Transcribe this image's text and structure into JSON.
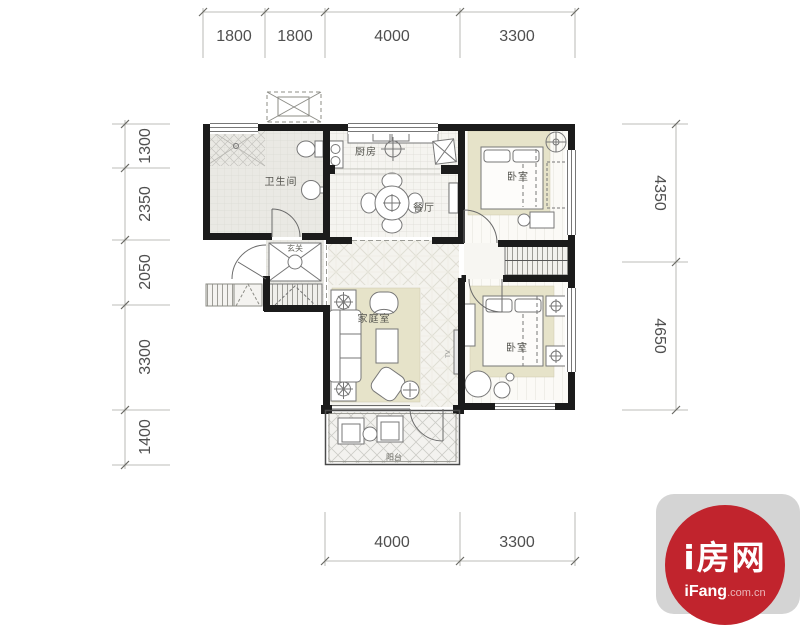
{
  "branding": {
    "site_name": "i房网",
    "domain_bold": "iFang",
    "domain_rest": ".com.cn",
    "brand_red": "#c1242d",
    "tile_gray": "#d4d4d4"
  },
  "floorplan": {
    "rooms": [
      {
        "id": "bathroom",
        "label": "卫生间"
      },
      {
        "id": "kitchen",
        "label": "厨房"
      },
      {
        "id": "dining-room",
        "label": "餐厅"
      },
      {
        "id": "entry-hall",
        "label": "玄关"
      },
      {
        "id": "family-room",
        "label": "家庭室"
      },
      {
        "id": "bedroom-top",
        "label": "卧室"
      },
      {
        "id": "bedroom-bottom",
        "label": "卧室"
      },
      {
        "id": "balcony",
        "label": "阳台"
      }
    ],
    "tv_label": "TV",
    "dimensions_mm": {
      "top": [
        "1800",
        "1800",
        "4000",
        "3300"
      ],
      "left": [
        "1300",
        "2350",
        "2050",
        "3300",
        "1400"
      ],
      "right": [
        "4350",
        "4650"
      ],
      "bottom": [
        "4000",
        "3300"
      ]
    },
    "wall_color": "#1b1b1b",
    "rug_color": "#e6e3c9"
  }
}
